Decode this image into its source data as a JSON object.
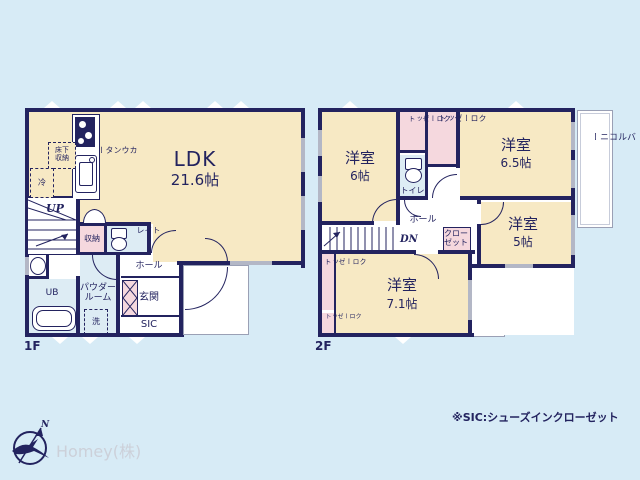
{
  "colors": {
    "wall": "#23235f",
    "room_cream": "#f7e9c4",
    "closet_pink": "#f5d8de",
    "wet_blue": "#ddecf4",
    "background": "#d7ebf6",
    "window_gray": "#b3b7c6",
    "company_gray": "#ccd0d9"
  },
  "floor1": {
    "label": "1F",
    "ldk": {
      "name": "LDK",
      "size": "21.6帖"
    },
    "kitchen": {
      "counter": "カウンター",
      "underfloor_storage": "床下\n収納",
      "fridge": "冷"
    },
    "stairs_label": "UP",
    "storage_label": "収納",
    "toilet_label": "トイレ",
    "hall_label": "ホール",
    "ub_label": "UB",
    "powder_room_label": "パウダー\nルーム",
    "laundry_label": "洗",
    "entrance_label": "玄関",
    "sic_label": "SIC"
  },
  "floor2": {
    "label": "2F",
    "rooms": [
      {
        "name": "洋室",
        "size": "6帖"
      },
      {
        "name": "洋室",
        "size": "6.5帖"
      },
      {
        "name": "洋室",
        "size": "5帖"
      },
      {
        "name": "洋室",
        "size": "7.1帖"
      }
    ],
    "closet_labels": [
      "クローゼット",
      "クローゼット",
      "クロー\nゼット",
      "クローゼット",
      "クローゼット"
    ],
    "toilet_label": "トイレ",
    "hall_label": "ホール",
    "stairs_label": "DN",
    "balcony_labels": [
      "バルコニー",
      "バルコニー"
    ]
  },
  "footer": {
    "note": "※SIC:シューズインクローゼット",
    "company": "Homey(株)"
  },
  "compass": {
    "north": "N"
  }
}
